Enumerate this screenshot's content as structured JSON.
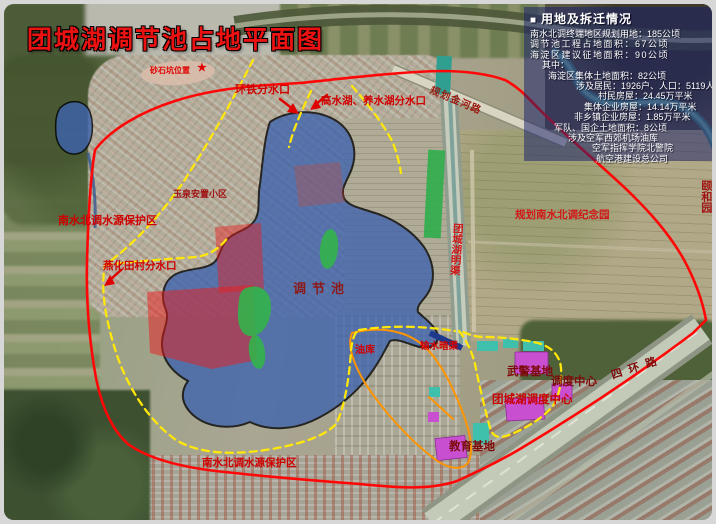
{
  "page": {
    "title": "团城湖调节池占地平面图"
  },
  "legend": {
    "bullet": "■",
    "title": "用地及拆迁情况",
    "lines": [
      "南水北调终端地区规划用地：185公顷",
      "调节池工程占地面积：67公顷",
      "海淀区建议征地面积：90公顷",
      "其中：",
      "海淀区集体土地面积：82公顷",
      "涉及居民：1926户、人口：5119人",
      "村民房屋：24.45万平米",
      "集体企业房屋：14.14万平米",
      "非乡镇企业房屋：1.85万平米",
      "军队、国企土地面积：8公顷",
      "涉及空军西郊机场油库",
      "空军指挥学院北警院",
      "航空港建设总公司"
    ]
  },
  "map_labels": {
    "pit_note": "砂石坑位置",
    "pit_marker": "★",
    "huantie_outlet": "环铁分水口",
    "gaoshuihu_outlet": "高水湖、养水湖分水口",
    "protection_zone_north": "南水北调水源保护区",
    "yuquan_block": "玉泉安置小区",
    "yanhua_outlet": "燕化田村分水口",
    "regulation_pool": "调节池",
    "memorial_park": "规划南水北调纪念园",
    "open_channel": "团城湖明渠",
    "jinhe_road": "规划金河路",
    "summer_palace": "颐和园",
    "oil_depot": "油库",
    "culvert": "输水暗渠",
    "armed_police_base": "武警基地",
    "dispatch_center": "调度中心",
    "tuanchenghu_dispatch_center": "团城湖调度中心",
    "education_base": "教育基地",
    "protection_zone_south": "南水北调水源保护区",
    "fourth_ring_road": "四环路"
  },
  "colors": {
    "title_red": "#ec1212",
    "boundary_red": "#ff0707",
    "dash_yellow": "#ffe70a",
    "orange_line": "#ff9500",
    "pond_blue": "#3d63ae",
    "green_patch": "#33b24b",
    "red_zone": "#ec1c1c",
    "magenta_building": "#c94fd1",
    "teal_building": "#3fc0ad",
    "legend_bg": "rgba(24,32,108,0.52)"
  }
}
